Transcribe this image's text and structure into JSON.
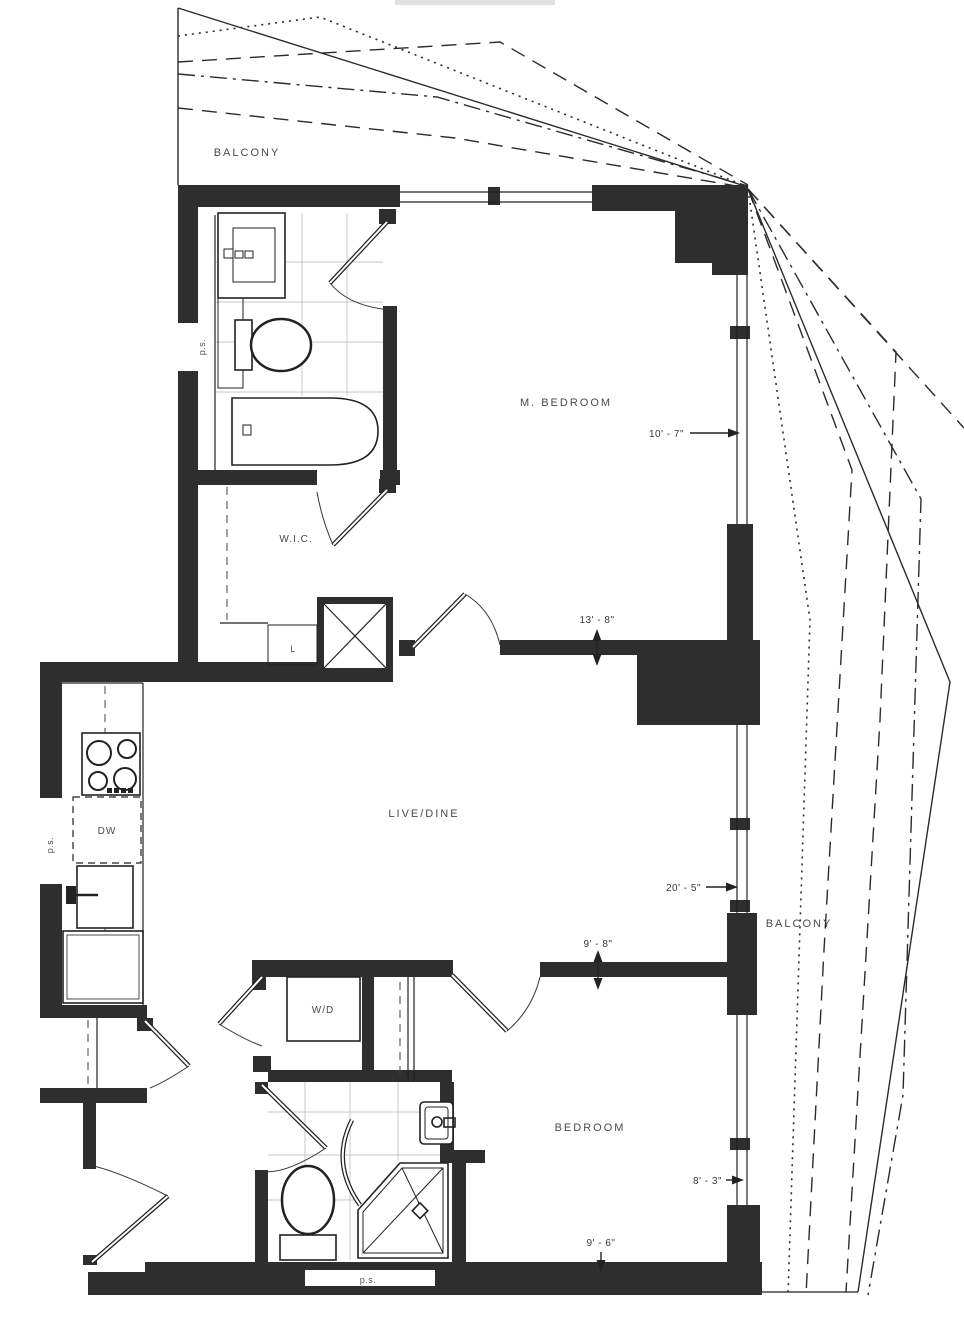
{
  "plan": {
    "rooms": {
      "balcony_top": "BALCONY",
      "m_bedroom": "M. BEDROOM",
      "wic": "W.I.C.",
      "linen": "L",
      "live_dine": "LIVE/DINE",
      "dishwasher": "DW",
      "washer_dryer": "W/D",
      "bedroom": "BEDROOM",
      "balcony_right": "BALCONY"
    },
    "dimensions": {
      "m_bedroom_width": "10' - 7\"",
      "m_bedroom_length": "13' - 8\"",
      "live_dine_length": "20' - 5\"",
      "bedroom_top_width": "9' - 8\"",
      "bedroom_depth": "8' - 3\"",
      "bedroom_bottom_width": "9' - 6\""
    },
    "annotations": {
      "ps_bath1": "p.s.",
      "ps_kitchen": "p.s.",
      "ps_bath2": "p.s."
    },
    "colors": {
      "wall": "#2e2e2e",
      "line": "#222222",
      "paper": "#ffffff"
    }
  }
}
